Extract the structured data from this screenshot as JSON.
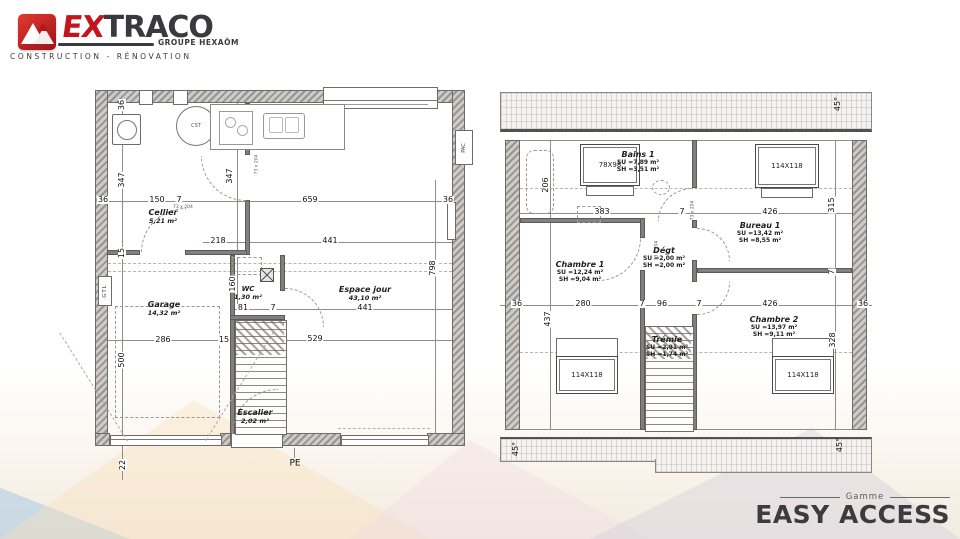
{
  "logo": {
    "brand_prefix": "EX",
    "brand_suffix": "TRACO",
    "group_label": "GROUPE HEXAÔM",
    "tagline": "CONSTRUCTION - RÉNOVATION"
  },
  "footer": {
    "series_label": "Gamme",
    "series_name": "EASY ACCESS"
  },
  "gf": {
    "rooms": {
      "cellier": {
        "name": "Cellier",
        "area": "5,21 m²"
      },
      "garage": {
        "name": "Garage",
        "area": "14,32 m²"
      },
      "wc": {
        "name": "WC",
        "area": "1,30 m²"
      },
      "escalier": {
        "name": "Escalier",
        "area": "2,02 m²"
      },
      "espace": {
        "name": "Espace jour",
        "area": "43,10 m²"
      }
    },
    "eq": {
      "cst": "CST",
      "gtl": "GTL",
      "pe": "PE",
      "pac": "PAC"
    },
    "door_tag": "73 x 204",
    "dims": {
      "d36": "36",
      "d347": "347",
      "d150": "150",
      "d7": "7",
      "d659": "659",
      "d218": "218",
      "d441": "441",
      "d15": "15",
      "d160": "160",
      "d81": "81",
      "d529": "529",
      "d798": "798",
      "d286": "286",
      "d500": "500",
      "d22": "22"
    }
  },
  "uf": {
    "rooms": {
      "bains1": {
        "name": "Bains 1",
        "su": "SU =7,89 m²",
        "sh": "SH =3,51 m²"
      },
      "chambre1": {
        "name": "Chambre 1",
        "su": "SU =12,24 m²",
        "sh": "SH =9,04 m²"
      },
      "degt": {
        "name": "Dégt",
        "su": "SU =2,00 m²",
        "sh": "SH =2,00 m²"
      },
      "bureau1": {
        "name": "Bureau 1",
        "su": "SU =13,42 m²",
        "sh": "SH =8,55 m²"
      },
      "chambre2": {
        "name": "Chambre 2",
        "su": "SU =13,97 m²",
        "sh": "SH =9,11 m²"
      },
      "tremie": {
        "name": "Trémie",
        "su": "SU =2,91 m²",
        "sh": "SH =1,74 m²"
      }
    },
    "windows": {
      "small": "78X98",
      "large": "114X118"
    },
    "roof_angle": "45°",
    "door_tag": "73 x 204",
    "dims": {
      "d206": "206",
      "d383": "383",
      "d7": "7",
      "d426": "426",
      "d315": "315",
      "d328": "328",
      "d36": "36",
      "d280": "280",
      "d96": "96",
      "d437": "437"
    }
  }
}
